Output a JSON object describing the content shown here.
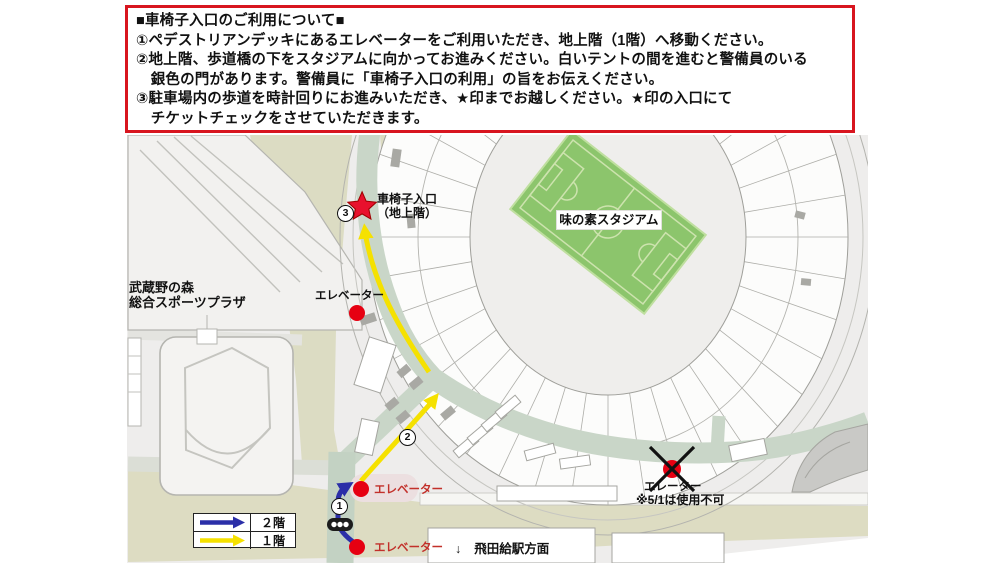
{
  "instruction_box": {
    "lines": [
      "■車椅子入口のご利用について■",
      "①ペデストリアンデッキにあるエレベーターをご利用いただき、地上階（1階）へ移動ください。",
      "②地上階、歩道橋の下をスタジアムに向かってお進みください。白いテントの間を進むと警備員のいる",
      "　銀色の門があります。警備員に「車椅子入口の利用」の旨をお伝えください。",
      "③駐車場内の歩道を時計回りにお進みいただき、★印までお越しください。★印の入口にて",
      "　チケットチェックをさせていただきます。"
    ]
  },
  "map": {
    "stadium_label": "味の素スタジアム",
    "plaza_label_line1": "武蔵野の森",
    "plaza_label_line2": "総合スポーツプラザ",
    "wheelchair_entrance_line1": "車椅子入口",
    "wheelchair_entrance_line2": "（地上階）",
    "elevator_top_label": "エレベーター",
    "elevator_mid_label": "エレベーター",
    "elevator_bottom_label": "エレベーター",
    "elevator_right_label": "エレーター",
    "elevator_right_note": "※5/1は使用不可",
    "station_arrow": "↓",
    "station_direction": "飛田給駅方面",
    "marker1": "1",
    "marker2": "2",
    "marker3": "3"
  },
  "legend": {
    "floor2_label": "２階",
    "floor1_label": "１階"
  },
  "colors": {
    "box_border": "#d8151f",
    "route_floor1_yellow": "#f5e100",
    "route_floor2_blue": "#2b2fa8",
    "marker_red": "#e60012",
    "field_green": "#8cc56c",
    "road_green": "#c9d6c8",
    "road_khaki": "#dddcc2"
  }
}
